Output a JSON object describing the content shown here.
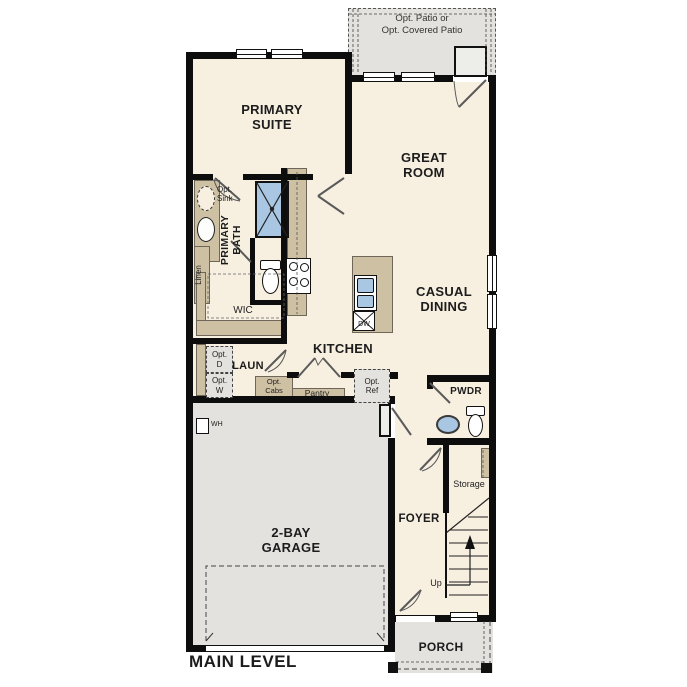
{
  "title": "MAIN LEVEL",
  "colors": {
    "floor": "#f7efe0",
    "exterior_surface": "#e3e2de",
    "casework": "#cec0a3",
    "fixture_blue": "#a9c7e2",
    "wall": "#0d0d0d",
    "background": "#ffffff"
  },
  "rooms": {
    "patio": {
      "line1": "Opt. Patio or",
      "line2": "Opt. Covered Patio"
    },
    "primary_suite": {
      "label": "PRIMARY SUITE"
    },
    "great_room": {
      "label": "GREAT ROOM"
    },
    "primary_bath": {
      "label": "PRIMARY BATH"
    },
    "wic": {
      "label": "WIC"
    },
    "casual_dining": {
      "label": "CASUAL DINING"
    },
    "kitchen": {
      "label": "KITCHEN"
    },
    "laundry": {
      "label": "LAUN"
    },
    "powder": {
      "label": "PWDR"
    },
    "storage": {
      "label": "Storage"
    },
    "foyer": {
      "label": "FOYER"
    },
    "garage": {
      "label": "2-BAY GARAGE"
    },
    "porch": {
      "label": "PORCH"
    }
  },
  "annotations": {
    "opt_sink": "Opt. Sink",
    "linen": "Linen",
    "opt_dryer": "Opt. D",
    "opt_washer": "Opt. W",
    "opt_cabs": "Opt. Cabs",
    "pantry": "Pantry",
    "opt_ref": "Opt. Ref",
    "dishwasher": "DW",
    "water_heater": "WH",
    "stairs_up": "Up"
  }
}
